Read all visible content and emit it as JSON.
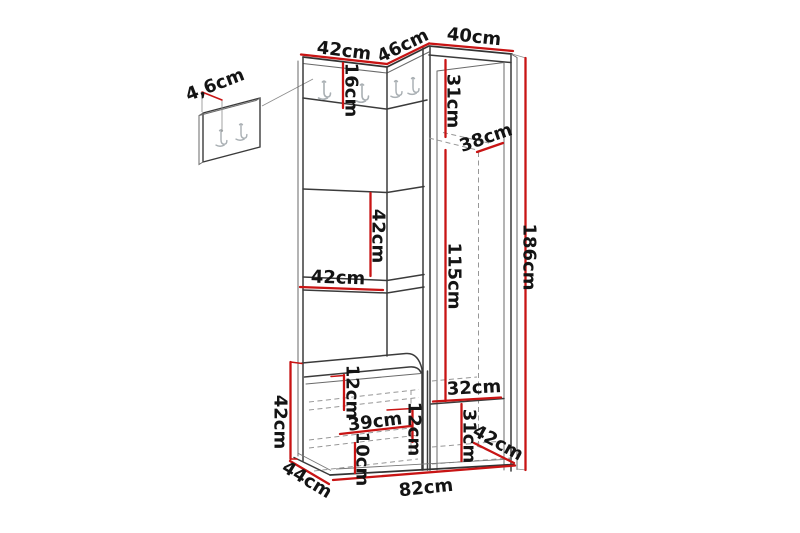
{
  "diagram": {
    "product": "Hallway furniture set dimension drawing (corner wardrobe, hook panels, bench)",
    "unit": "cm",
    "accent_color": "#c81414",
    "outline_color": "#3b3b3b",
    "hidden_line_color": "#979797",
    "background_color": "#ffffff",
    "dimensions": {
      "detail_panel_depth": "4,6cm",
      "left_panel_width": "42cm",
      "corner_panel_width": "46cm",
      "wardrobe_width": "40cm",
      "hook_strip_height": "16cm",
      "wardrobe_top_shelf_height": "31cm",
      "wardrobe_shelf_depth": "38cm",
      "middle_section_height": "42cm",
      "middle_shelf_width": "42cm",
      "hanging_section_height": "115cm",
      "total_height": "186cm",
      "bench_height": "42cm",
      "seat_box_height": "12cm",
      "bench_inner_width": "39cm",
      "bench_bottom_height": "10cm",
      "side_panel_height": "12cm",
      "bottom_shelf_width": "32cm",
      "bottom_shelf_height": "31cm",
      "wardrobe_depth": "42cm",
      "bench_depth": "44cm",
      "base_width": "82cm"
    }
  }
}
